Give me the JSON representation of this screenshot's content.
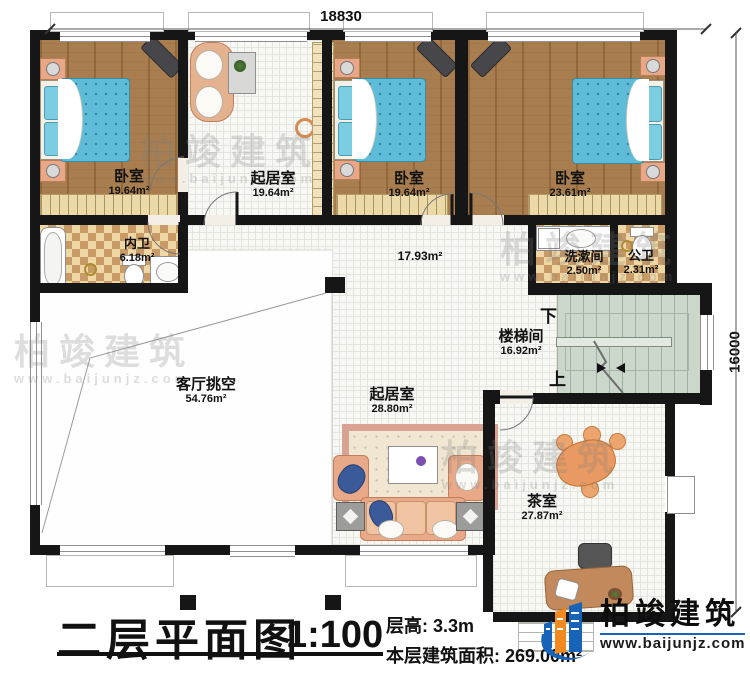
{
  "plan": {
    "dim_width": "18830",
    "dim_height": "16000",
    "rooms": [
      {
        "name": "卧室",
        "area": "19.64m²"
      },
      {
        "name": "起居室",
        "area": "19.64m²"
      },
      {
        "name": "卧室",
        "area": "19.64m²"
      },
      {
        "name": "卧室",
        "area": "23.61m²"
      },
      {
        "name": "内卫",
        "area": "6.18m²"
      },
      {
        "name": "",
        "area": "17.93m²"
      },
      {
        "name": "洗漱间",
        "area": "2.50m²"
      },
      {
        "name": "公卫",
        "area": "2.31m²"
      },
      {
        "name": "楼梯间",
        "area": "16.92m²"
      },
      {
        "name": "客厅挑空",
        "area": "54.76m²"
      },
      {
        "name": "起居室",
        "area": "28.80m²"
      },
      {
        "name": "茶室",
        "area": "27.87m²"
      }
    ],
    "stairs": {
      "down": "下",
      "up": "上"
    }
  },
  "titleblock": {
    "title": "二层平面图",
    "scale": "1:100",
    "floor_height": "层高: 3.3m",
    "floor_area": "本层建筑面积: 269.00m²"
  },
  "brand": {
    "name": "柏竣建筑",
    "website": "www.baijunjz.com"
  },
  "watermark": {
    "name": "柏竣建筑",
    "website": "www.baijunjz.com"
  },
  "colors": {
    "wall": "#161616",
    "wood": "#a87e50",
    "bed": "#5fbcd8",
    "stair_floor": "#ccd7cb",
    "checker": "#c79a66",
    "sofa": "#e9a888",
    "brand_blue": "#1763b8",
    "brand_orange": "#f08a1e"
  }
}
